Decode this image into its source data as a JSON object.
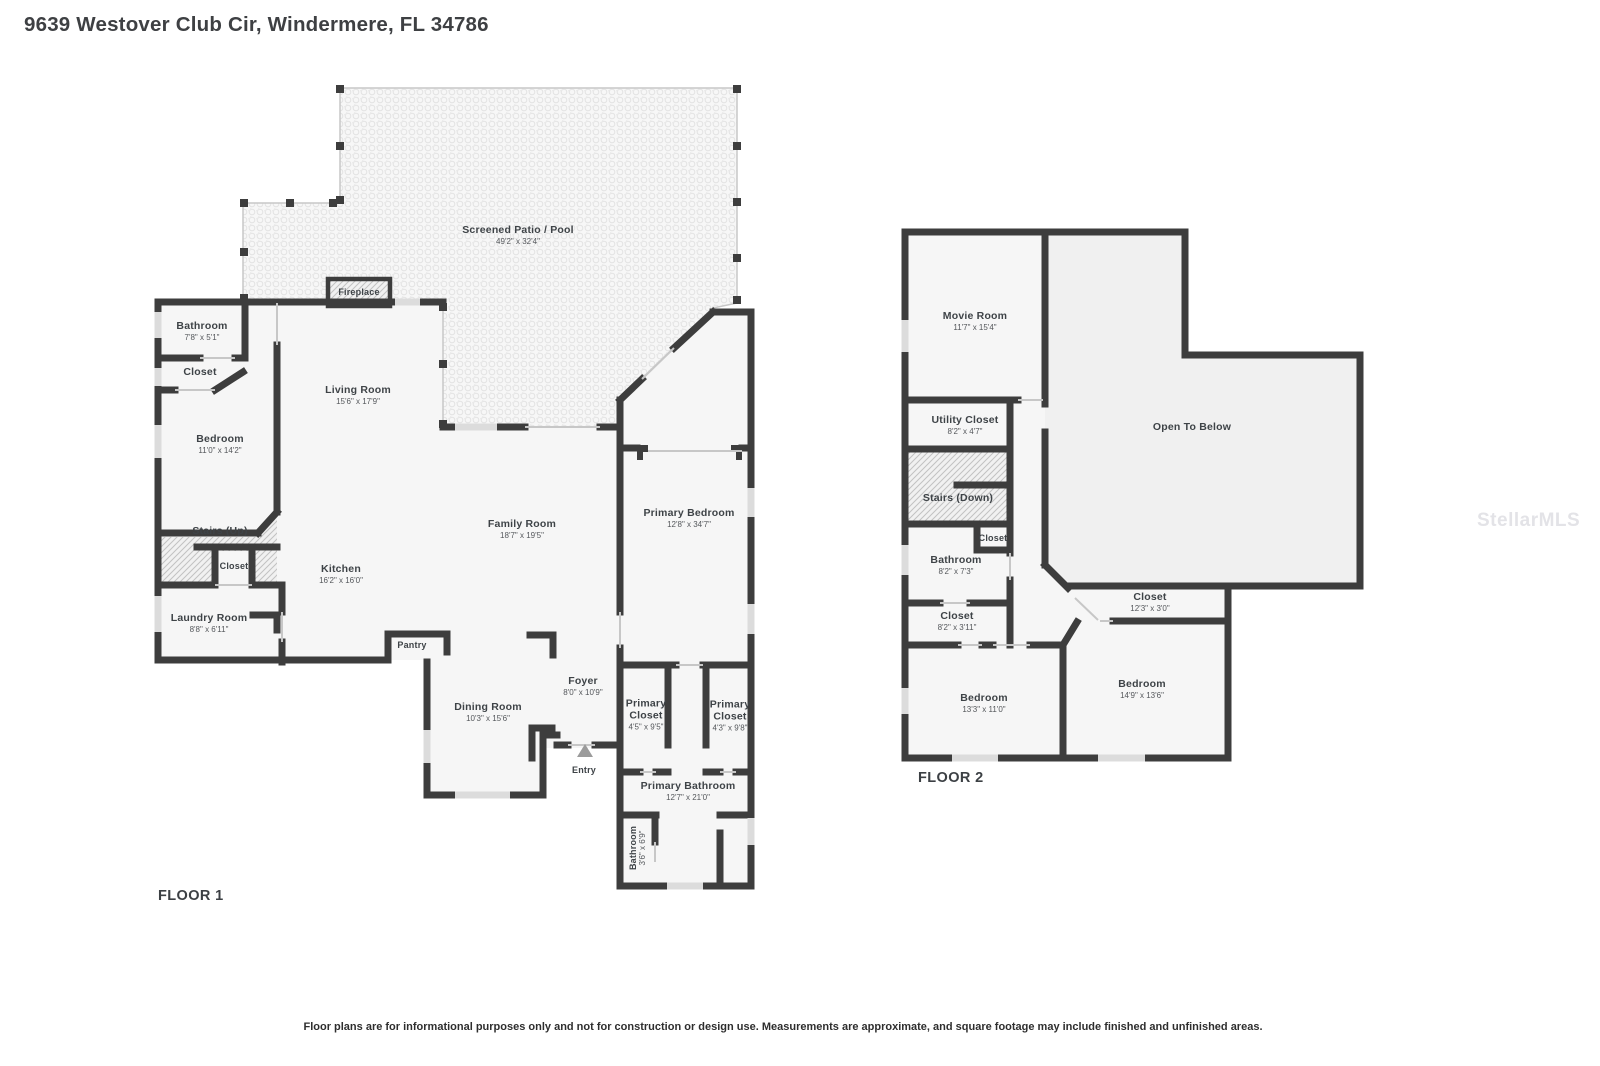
{
  "title": "9639 Westover Club Cir, Windermere, FL 34786",
  "watermark": "StellarMLS",
  "disclaimer": "Floor plans are for informational purposes only and not for construction or design use. Measurements are approximate, and square footage may include finished and unfinished areas.",
  "floor1": {
    "label": "FLOOR 1",
    "rooms": [
      {
        "name": "Screened Patio / Pool",
        "dims": "49'2\" x 32'4\""
      },
      {
        "name": "Fireplace",
        "dims": ""
      },
      {
        "name": "Bathroom",
        "dims": "7'8\" x 5'1\""
      },
      {
        "name": "Closet",
        "dims": ""
      },
      {
        "name": "Living Room",
        "dims": "15'6\" x 17'9\""
      },
      {
        "name": "Bedroom",
        "dims": "11'0\" x 14'2\""
      },
      {
        "name": "Stairs (Up)",
        "dims": ""
      },
      {
        "name": "Closet",
        "dims": ""
      },
      {
        "name": "Kitchen",
        "dims": "16'2\" x 16'0\""
      },
      {
        "name": "Family Room",
        "dims": "18'7\" x 19'5\""
      },
      {
        "name": "Primary Bedroom",
        "dims": "12'8\" x 34'7\""
      },
      {
        "name": "Laundry Room",
        "dims": "8'8\" x 6'11\""
      },
      {
        "name": "Pantry",
        "dims": ""
      },
      {
        "name": "Dining Room",
        "dims": "10'3\" x 15'6\""
      },
      {
        "name": "Foyer",
        "dims": "8'0\" x 10'9\""
      },
      {
        "name": "Entry",
        "dims": ""
      },
      {
        "name": "Primary Closet",
        "dims": "4'5\" x 9'5\""
      },
      {
        "name": "Primary Closet",
        "dims": "4'3\" x 9'8\""
      },
      {
        "name": "Primary Bathroom",
        "dims": "12'7\" x 21'0\""
      },
      {
        "name": "Bathroom",
        "dims": "3'6\" x 6'9\""
      }
    ]
  },
  "floor2": {
    "label": "FLOOR 2",
    "rooms": [
      {
        "name": "Movie Room",
        "dims": "11'7\" x 15'4\""
      },
      {
        "name": "Open To Below",
        "dims": ""
      },
      {
        "name": "Utility Closet",
        "dims": "8'2\" x 4'7\""
      },
      {
        "name": "Stairs (Down)",
        "dims": ""
      },
      {
        "name": "Closet",
        "dims": ""
      },
      {
        "name": "Bathroom",
        "dims": "8'2\" x 7'3\""
      },
      {
        "name": "Closet",
        "dims": "8'2\" x 3'11\""
      },
      {
        "name": "Closet",
        "dims": "12'3\" x 3'0\""
      },
      {
        "name": "Bedroom",
        "dims": "13'3\" x 11'0\""
      },
      {
        "name": "Bedroom",
        "dims": "14'9\" x 13'6\""
      }
    ]
  }
}
